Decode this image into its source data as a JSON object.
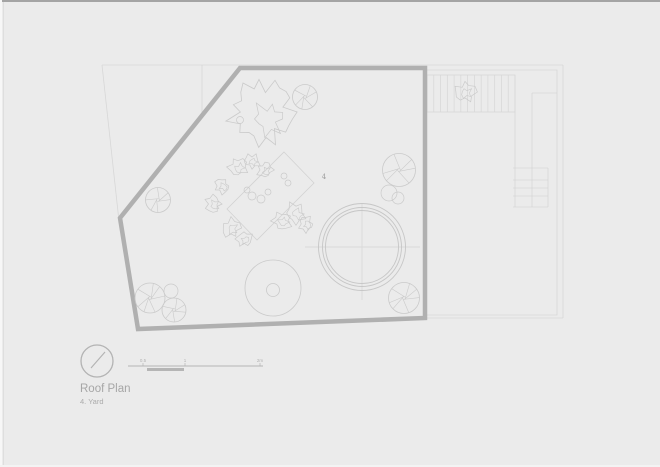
{
  "window": {
    "background": "#ebebeb",
    "top_border_color": "#a4a4a4"
  },
  "title_block": {
    "title": "Roof Plan",
    "subtitle": "4. Yard",
    "north_arrow_icon": "north-arrow-icon",
    "compass": {
      "cx": 97,
      "cy": 361,
      "r": 16,
      "needle": [
        [
          91,
          368
        ],
        [
          105,
          352
        ]
      ]
    },
    "scale_bar": {
      "labels": [
        "0.5",
        "1",
        "2m"
      ],
      "label_x": [
        143,
        185,
        260
      ],
      "label_y": 362,
      "thin_line": [
        [
          128,
          366
        ],
        [
          263,
          366
        ]
      ],
      "thick_bar": {
        "x1": 147,
        "x2": 184,
        "y": 368,
        "h": 3
      },
      "tick_y1": 363,
      "tick_y2": 366
    },
    "title_pos": {
      "x": 80,
      "y": 392
    },
    "subtitle_pos": {
      "x": 80,
      "y": 404
    }
  },
  "plan": {
    "area_label": "4",
    "area_label_pos": {
      "x": 324,
      "y": 179
    },
    "colors": {
      "wall": "#b0b0b0",
      "faint": "#d7d7d7",
      "hatch": "#d6d6d6",
      "drawing": "#cacaca",
      "pond": "#c6c6c6",
      "cross": "#d5d5d5",
      "compass": "#b3b3b3",
      "scale": "#b5b5b5",
      "background": "#ebebeb"
    },
    "yard_outline": [
      [
        240,
        68
      ],
      [
        425,
        68
      ],
      [
        425,
        318
      ],
      [
        138,
        329
      ],
      [
        120,
        218
      ]
    ],
    "property_lines": [
      {
        "name": "lot-line-top",
        "pts": [
          [
            102,
            65
          ],
          [
            563,
            65
          ]
        ]
      },
      {
        "name": "lot-line-right",
        "pts": [
          [
            563,
            65
          ],
          [
            563,
            318
          ]
        ]
      },
      {
        "name": "lot-line-bottom",
        "pts": [
          [
            563,
            318
          ],
          [
            427,
            318
          ]
        ]
      },
      {
        "name": "lot-line-left",
        "pts": [
          [
            102,
            65
          ],
          [
            119,
            221
          ]
        ]
      },
      {
        "name": "neighbor-roof-outline",
        "pts": [
          [
            427,
            70
          ],
          [
            557,
            70
          ],
          [
            557,
            315
          ],
          [
            427,
            315
          ]
        ]
      },
      {
        "name": "lot-line-division",
        "pts": [
          [
            202,
            65
          ],
          [
            202,
            113
          ]
        ]
      },
      {
        "name": "corridor-left",
        "pts": [
          [
            515,
            75
          ],
          [
            515,
            207
          ]
        ]
      },
      {
        "name": "corridor-mid",
        "pts": [
          [
            532,
            93
          ],
          [
            532,
            207
          ]
        ]
      },
      {
        "name": "corridor-top",
        "pts": [
          [
            532,
            93
          ],
          [
            557,
            93
          ]
        ]
      },
      {
        "name": "stairs-right-edge",
        "pts": [
          [
            548,
            168
          ],
          [
            548,
            207
          ]
        ]
      }
    ],
    "stair_band": {
      "x1": 427,
      "y1": 75,
      "x2": 515,
      "y2": 112,
      "hatch_lines": 12
    },
    "stair_lower": {
      "x1": 513,
      "x2": 548,
      "tread_ys": [
        168,
        180,
        188,
        196,
        207
      ]
    },
    "big_tree": {
      "cx": 263,
      "cy": 112,
      "r": 36,
      "inner": {
        "dx": 6,
        "dy": 7,
        "r": 19
      },
      "dot": {
        "cx": 240,
        "cy": 120,
        "r": 3.5
      }
    },
    "trees": [
      {
        "cx": 305,
        "cy": 97,
        "r": 12.5,
        "seed": 1,
        "spokes": 6
      },
      {
        "cx": 158,
        "cy": 200,
        "r": 12.5,
        "seed": 2,
        "spokes": 6
      },
      {
        "cx": 150,
        "cy": 298,
        "r": 15,
        "seed": 3,
        "spokes": 7
      },
      {
        "cx": 174,
        "cy": 310,
        "r": 12,
        "seed": 4,
        "spokes": 6
      },
      {
        "cx": 399,
        "cy": 170,
        "r": 16.5,
        "seed": 5,
        "spokes": 6
      },
      {
        "cx": 404,
        "cy": 298,
        "r": 15.5,
        "seed": 6,
        "spokes": 7
      }
    ],
    "plain_circles": [
      {
        "cx": 171,
        "cy": 291,
        "r": 7
      },
      {
        "cx": 389,
        "cy": 193,
        "r": 8
      },
      {
        "cx": 398,
        "cy": 198,
        "r": 6
      }
    ],
    "shrubs": [
      {
        "cx": 238,
        "cy": 167,
        "r": 11,
        "seed": 11
      },
      {
        "cx": 252,
        "cy": 161,
        "r": 9,
        "seed": 12
      },
      {
        "cx": 222,
        "cy": 186,
        "r": 9,
        "seed": 13
      },
      {
        "cx": 213,
        "cy": 204,
        "r": 10,
        "seed": 14
      },
      {
        "cx": 231,
        "cy": 228,
        "r": 11,
        "seed": 15
      },
      {
        "cx": 244,
        "cy": 239,
        "r": 9,
        "seed": 16
      },
      {
        "cx": 282,
        "cy": 221,
        "r": 11,
        "seed": 17
      },
      {
        "cx": 296,
        "cy": 213,
        "r": 12,
        "seed": 18
      },
      {
        "cx": 306,
        "cy": 224,
        "r": 9,
        "seed": 19
      },
      {
        "cx": 265,
        "cy": 170,
        "r": 9,
        "seed": 20
      },
      {
        "cx": 465,
        "cy": 92,
        "r": 12,
        "seed": 21
      }
    ],
    "stones": [
      {
        "cx": 252,
        "cy": 196,
        "r": 4
      },
      {
        "cx": 261,
        "cy": 199,
        "r": 4
      },
      {
        "cx": 268,
        "cy": 192,
        "r": 3
      },
      {
        "cx": 247,
        "cy": 190,
        "r": 3
      },
      {
        "cx": 284,
        "cy": 176,
        "r": 3
      },
      {
        "cx": 288,
        "cy": 183,
        "r": 3
      }
    ],
    "deck": [
      [
        284,
        152
      ],
      [
        314,
        183
      ],
      [
        257,
        240
      ],
      [
        227,
        209
      ]
    ],
    "pond": {
      "cx": 362,
      "cy": 247,
      "radii": [
        43.5,
        39.5,
        36.5
      ],
      "cross_h": [
        [
          305,
          247
        ],
        [
          420,
          247
        ]
      ],
      "cross_v": [
        [
          362,
          203
        ],
        [
          362,
          300
        ]
      ]
    },
    "table": {
      "cx": 273,
      "cy": 288,
      "r": 28,
      "inner_cx": 273,
      "inner_cy": 290,
      "inner_r": 6.5
    }
  }
}
